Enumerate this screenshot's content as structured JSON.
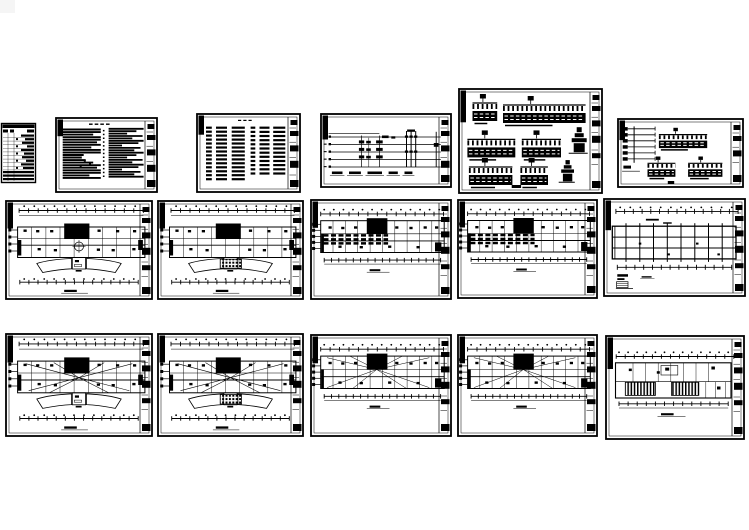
{
  "canvas": {
    "width": 749,
    "height": 530
  },
  "palette": {
    "paper": "#ffffff",
    "ink": "#000000",
    "corner_thumb": "#f5f5f5"
  },
  "sheets": [
    {
      "id": "corner-thumb",
      "name": "corner-thumbnail",
      "kind": "gray",
      "x": 0,
      "y": 0,
      "w": 15,
      "h": 13
    },
    {
      "id": "index-table",
      "name": "drawing-index-table",
      "kind": "list",
      "x": 1,
      "y": 123,
      "w": 35,
      "h": 60
    },
    {
      "id": "design-notes",
      "name": "design-notes-sheet",
      "kind": "notes",
      "x": 55,
      "y": 117,
      "w": 103,
      "h": 76
    },
    {
      "id": "legend-schedule",
      "name": "legend-schedule-sheet",
      "kind": "legend",
      "x": 196,
      "y": 113,
      "w": 105,
      "h": 80
    },
    {
      "id": "riser-diagram",
      "name": "riser-system-diagram-sheet",
      "kind": "system",
      "x": 320,
      "y": 113,
      "w": 132,
      "h": 75
    },
    {
      "id": "panels-large",
      "name": "panel-diagrams-sheet-large",
      "kind": "panelsL",
      "x": 458,
      "y": 88,
      "w": 145,
      "h": 106
    },
    {
      "id": "panels-small",
      "name": "panel-diagrams-sheet-small",
      "kind": "panelsS",
      "x": 617,
      "y": 118,
      "w": 127,
      "h": 70
    },
    {
      "id": "plan-mid-1",
      "name": "floor-plan-sheet-1",
      "kind": "planFan",
      "x": 5,
      "y": 200,
      "w": 148,
      "h": 100,
      "opts": {
        "hub": true
      }
    },
    {
      "id": "plan-mid-2",
      "name": "floor-plan-sheet-2",
      "kind": "planFan",
      "x": 157,
      "y": 200,
      "w": 147,
      "h": 100,
      "opts": {
        "hatch": true
      }
    },
    {
      "id": "plan-mid-3",
      "name": "floor-plan-sheet-3",
      "kind": "planRect",
      "x": 310,
      "y": 199,
      "w": 142,
      "h": 101,
      "opts": {
        "dense": true
      }
    },
    {
      "id": "plan-mid-4",
      "name": "floor-plan-sheet-4",
      "kind": "planRect",
      "x": 457,
      "y": 199,
      "w": 141,
      "h": 100,
      "opts": {
        "dense": true
      }
    },
    {
      "id": "grid-plan",
      "name": "grid-plan-sheet",
      "kind": "gridPlan",
      "x": 603,
      "y": 198,
      "w": 143,
      "h": 99
    },
    {
      "id": "plan-bot-1",
      "name": "wiring-plan-sheet-1",
      "kind": "planFan",
      "x": 5,
      "y": 333,
      "w": 148,
      "h": 104,
      "opts": {
        "radial": true
      }
    },
    {
      "id": "plan-bot-2",
      "name": "wiring-plan-sheet-2",
      "kind": "planFan",
      "x": 157,
      "y": 333,
      "w": 147,
      "h": 104,
      "opts": {
        "radial": true,
        "hatch": true
      }
    },
    {
      "id": "plan-bot-3",
      "name": "wiring-plan-sheet-3",
      "kind": "planRect",
      "x": 310,
      "y": 334,
      "w": 142,
      "h": 103,
      "opts": {
        "radial": true
      }
    },
    {
      "id": "plan-bot-4",
      "name": "wiring-plan-sheet-4",
      "kind": "planRect",
      "x": 457,
      "y": 334,
      "w": 141,
      "h": 103,
      "opts": {
        "radial": true
      }
    },
    {
      "id": "roof-plan",
      "name": "roof-plan-sheet",
      "kind": "roofHatch",
      "x": 605,
      "y": 335,
      "w": 140,
      "h": 105
    }
  ]
}
